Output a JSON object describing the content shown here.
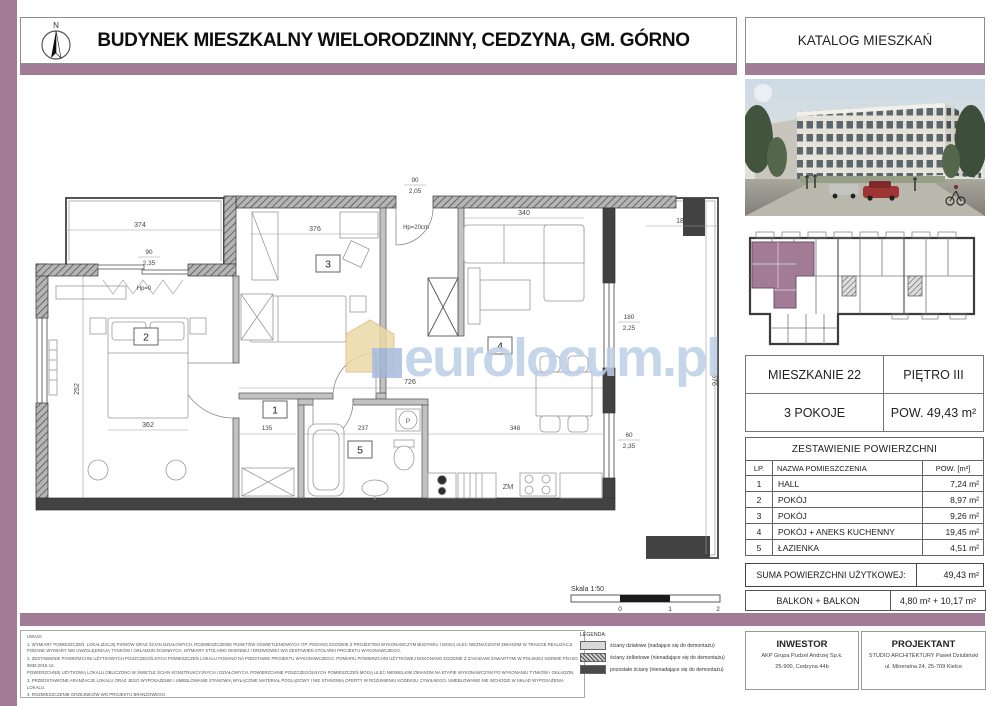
{
  "header": {
    "title": "BUDYNEK MIESZKALNY WIELORODZINNY, CEDZYNA, GM. GÓRNO",
    "catalog": "KATALOG MIESZKAŃ",
    "north": "N"
  },
  "summary": {
    "apartment": "MIESZKANIE 22",
    "floor": "PIĘTRO III",
    "rooms": "3 POKOJE",
    "area": "POW. 49,43 m²"
  },
  "area_table": {
    "title": "ZESTAWIENIE POWIERZCHNI",
    "col_lp": "LP.",
    "col_name": "NAZWA POMIESZCZENIA",
    "col_area": "POW. [m²]",
    "rows": [
      {
        "lp": "1",
        "name": "HALL",
        "area": "7,24 m²"
      },
      {
        "lp": "2",
        "name": "POKÓJ",
        "area": "8,97 m²"
      },
      {
        "lp": "3",
        "name": "POKÓJ",
        "area": "9,26 m²"
      },
      {
        "lp": "4",
        "name": "POKÓJ + ANEKS KUCHENNY",
        "area": "19,45 m²"
      },
      {
        "lp": "5",
        "name": "ŁAZIENKA",
        "area": "4,51 m²"
      }
    ],
    "sum_label": "SUMA POWIERZCHNI UŻYTKOWEJ:",
    "sum_value": "49,43 m²",
    "balcony_label": "BALKON + BALKON",
    "balcony_value": "4,80 m² + 10,17 m²"
  },
  "legend": {
    "title": "LEGENDA:",
    "items": [
      "ściany działowe (nadające się do demontażu)",
      "ściany żelbetowe (nienadające się do demontażu)",
      "pozostałe ściany (nienadające się do demontażu)"
    ]
  },
  "notes": {
    "title": "UWAGI:",
    "lines": [
      "1. WYMIARY POMIESZCZEŃ, LOKALIZACJĘ PIONÓW ORAZ ŚCIAN DZIAŁOWYCH, ROZMIESZCZENIE PUNKTÓW OŚWIETLENIOWYCH ITP. PODANO ZGODNIE Z PROJEKTEM WYKONAWCZYM BUDYNKU I MOGĄ ULEC NIEZNACZNYM ZMIANOM W TRAKCIE REALIZACJI. PODANE WYMIARY NIE UWZGLĘDNIAJĄ TYNKÓW I OKŁADZIN ŚCIENNYCH. WYMIARY STOLARKI OKIENNEJ I DRZWIOWEJ WG ZESTAWIEŃ STOLARKI PROJEKTU WYKONAWCZEGO.",
      "2. ZESTAWIENIE POWIERZCHNI UŻYTKOWYCH POSZCZEGÓLNYCH POMIESZCZEŃ LOKALU PODANO NA PODSTAWIE PROJEKTU WYKONAWCZEGO. POMIARU POWIERZCHNI UŻYTKOWEJ DOKONANO ZGODNIE Z ZASADAMI ZAWARTYMI W POLSKIEJ NORMIE PN-ISO 9836:2015-12.",
      "POWIERZCHNIĘ UŻYTKOWĄ LOKALU OBLICZONO W ŚWIETLE ŚCIAN KONSTRUKCYJNYCH I DZIAŁOWYCH. POWIERZCHNIE POSZCZEGÓLNYCH POMIESZCZEŃ MOGĄ ULEC NIEWIELKIM ZMIANOM NA ETAPIE WYKONAWCZYM PO WYKONANIU TYNKÓW I OKŁADZIN.",
      "3. PRZEDSTAWIONE ARANŻACJE LOKALU ORAZ JEGO WYPOSAŻENIE I UMEBLOWANIE STANOWIĄ WYŁĄCZNIE MATERIAŁ POGLĄDOWY I NIE STANOWIĄ OFERTY W ROZUMIENIU KODEKSU CYWILNEGO. UMEBLOWANIE NIE WCHODZI W SKŁAD WYPOSAŻENIA LOKALU.",
      "4. ROZMIESZCZENIE GRZEJNIKÓW WG PROJEKTU BRANŻOWEGO."
    ]
  },
  "footer": {
    "investor_title": "INWESTOR",
    "investor_line1": "AKP Grupa Pudzel Andrzej Sp.k.",
    "investor_line2": "25-900, Cedzyna 44b",
    "designer_title": "PROJEKTANT",
    "designer_line1": "STUDIO ARCHITEKTURY Paweł Dziubiński",
    "designer_line2": "ul. Mineralna 24, 25-709 Kielce"
  },
  "plan": {
    "rooms": {
      "r1": "1",
      "r2": "2",
      "r3": "3",
      "r4": "4",
      "r5": "5"
    },
    "dims": {
      "balcony_top": "374",
      "room3_w": "376",
      "sofa_w": "340",
      "balcony_right_w": "180",
      "balcony_right_h": "576",
      "bed_w": "362",
      "room2_h": "252",
      "hall_w": "726",
      "hall_bottom_w": "135",
      "bath_w": "237",
      "kitchen_w": "348"
    },
    "openings": {
      "entry_w": "90",
      "entry_h": "2,05",
      "entry_sill": "Hp=20cm",
      "balcony_sill": "Hp=0",
      "win_right_w": "180",
      "win_right_h": "2,25",
      "win_kitchen_w": "60",
      "win_kitchen_h": "2,35",
      "win_balcony_w": "90",
      "win_balcony_h": "2,35"
    },
    "labels": {
      "dishwasher": "ZM",
      "washer": "P"
    },
    "watermark": "eurolocum.pl",
    "scale_label": "Skala 1:50",
    "scale_ticks": [
      "0",
      "1",
      "2"
    ]
  },
  "colors": {
    "accent": "#a27b97",
    "wall_dark": "#424242",
    "watermark_blue": "#bdd0e7",
    "watermark_yellow": "#ecd9a8"
  }
}
